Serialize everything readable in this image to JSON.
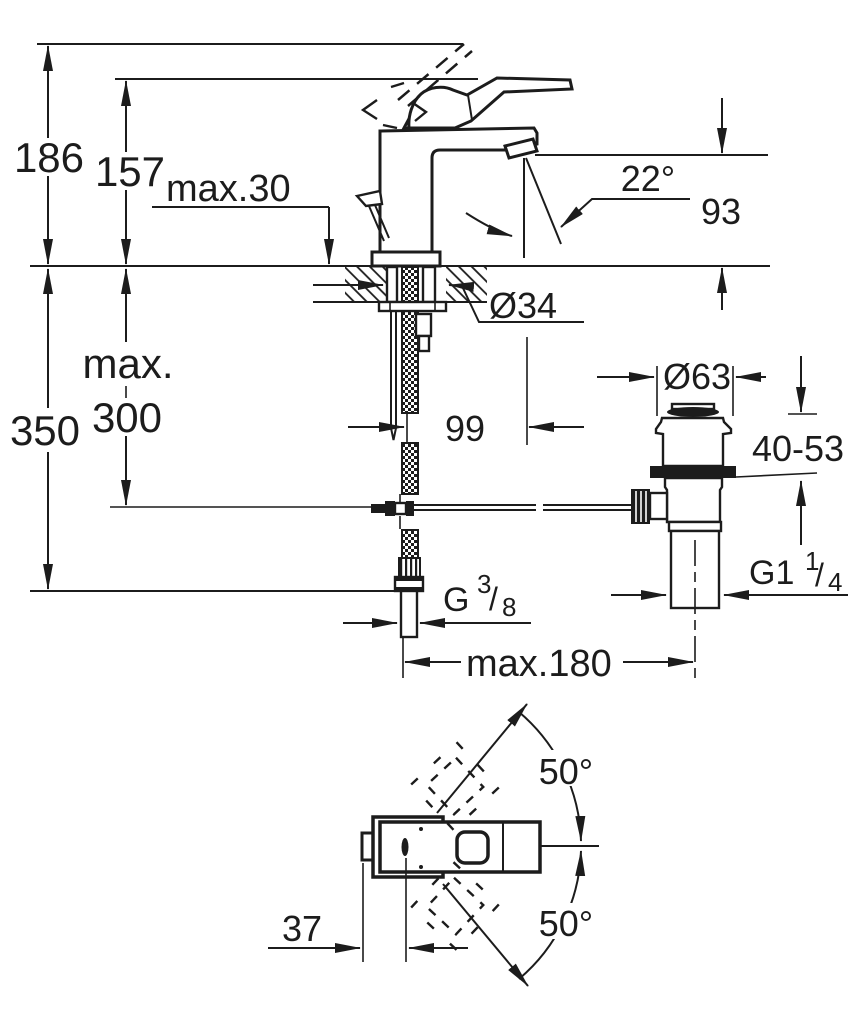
{
  "title": "Single-lever basin mixer with pop-up waste - installation dimension drawing",
  "colors": {
    "line": "#1c1c1c",
    "background": "#ffffff"
  },
  "side_view": {
    "dim_height_total": "186",
    "dim_height_lever": "157",
    "dim_deck_max": "max.30",
    "dim_spout_angle": "22°",
    "dim_spout_to_deck": "93",
    "dim_hole_diameter": "Ø34",
    "dim_hose_max_word": "max.",
    "dim_hose_max_value": "300",
    "dim_below_deck": "350",
    "dim_projection": "99",
    "dim_waste_diameter": "Ø63",
    "dim_clamp_range": "40-53",
    "dim_center_distance": "max.180",
    "thread_waste": {
      "base": "G1",
      "sup": "1",
      "slash": "/",
      "sub": "4"
    },
    "thread_supply": {
      "base": "G",
      "sup": "3",
      "slash": "/",
      "sub": "8"
    }
  },
  "top_view": {
    "dim_swivel_upper": "50°",
    "dim_swivel_lower": "50°",
    "dim_spout_tip_offset": "37"
  }
}
